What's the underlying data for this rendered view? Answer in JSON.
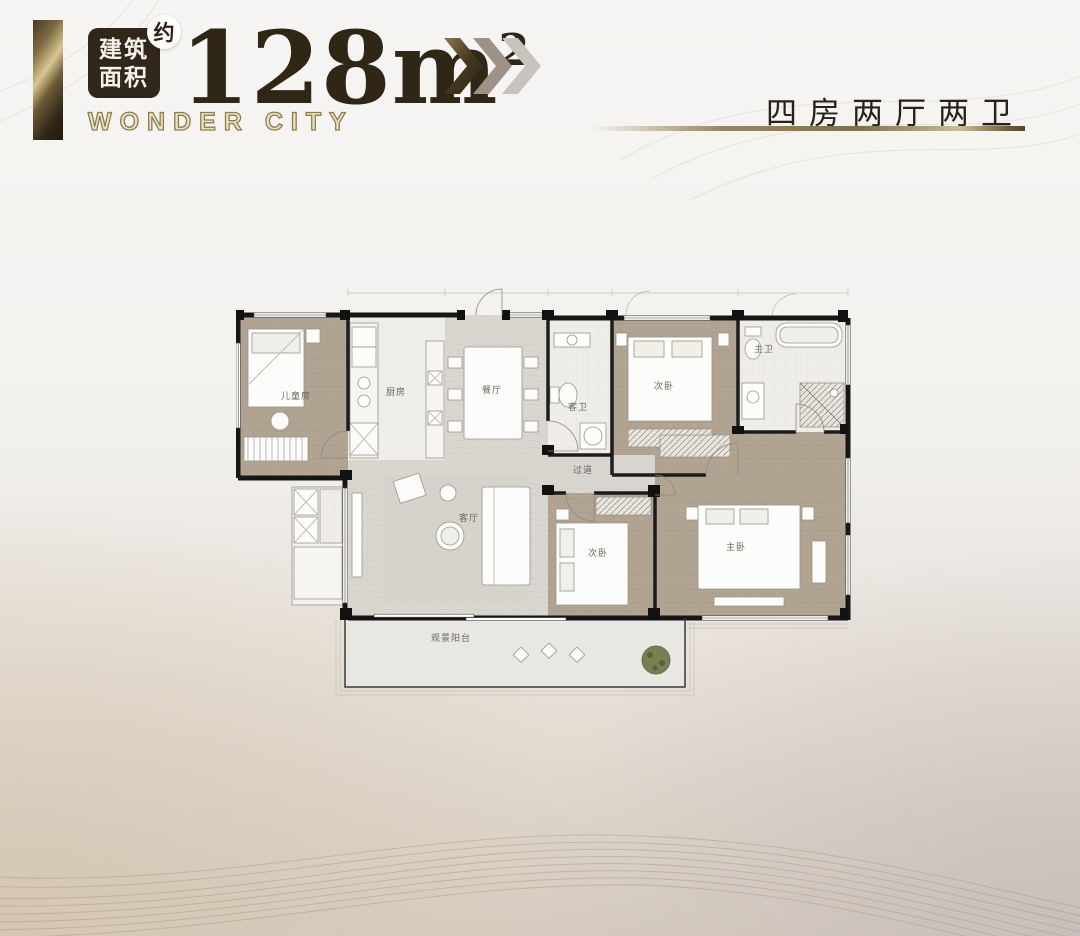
{
  "header": {
    "area_badge": {
      "line1": "建筑",
      "line2": "面积"
    },
    "approx_badge": "约",
    "area_value": "128",
    "area_unit": "m",
    "area_exponent": "2",
    "brand": "WONDER CITY",
    "layout_title": "四房两厅两卫",
    "colors": {
      "dark_brown": "#2f2616",
      "badge_bg": "#30261a",
      "gold": "#9a8759",
      "chevron_dark": "#4b3c26",
      "chevron_mid": "#9d9285",
      "chevron_light": "#c7c3bd"
    }
  },
  "floor_plan": {
    "rooms": [
      {
        "id": "kids-room",
        "label": "儿童房"
      },
      {
        "id": "kitchen",
        "label": "厨房"
      },
      {
        "id": "dining",
        "label": "餐厅"
      },
      {
        "id": "guest-bath",
        "label": "客卫"
      },
      {
        "id": "bedroom-top",
        "label": "次卧"
      },
      {
        "id": "master-bath",
        "label": "主卫"
      },
      {
        "id": "corridor",
        "label": "过道"
      },
      {
        "id": "living",
        "label": "客厅"
      },
      {
        "id": "bedroom-bottom",
        "label": "次卧"
      },
      {
        "id": "master-bedroom",
        "label": "主卧"
      },
      {
        "id": "balcony",
        "label": "观景阳台"
      }
    ],
    "wall_color": "#161616",
    "wood_floor": "#b2a492",
    "stone_floor": "#d9d6d0"
  }
}
